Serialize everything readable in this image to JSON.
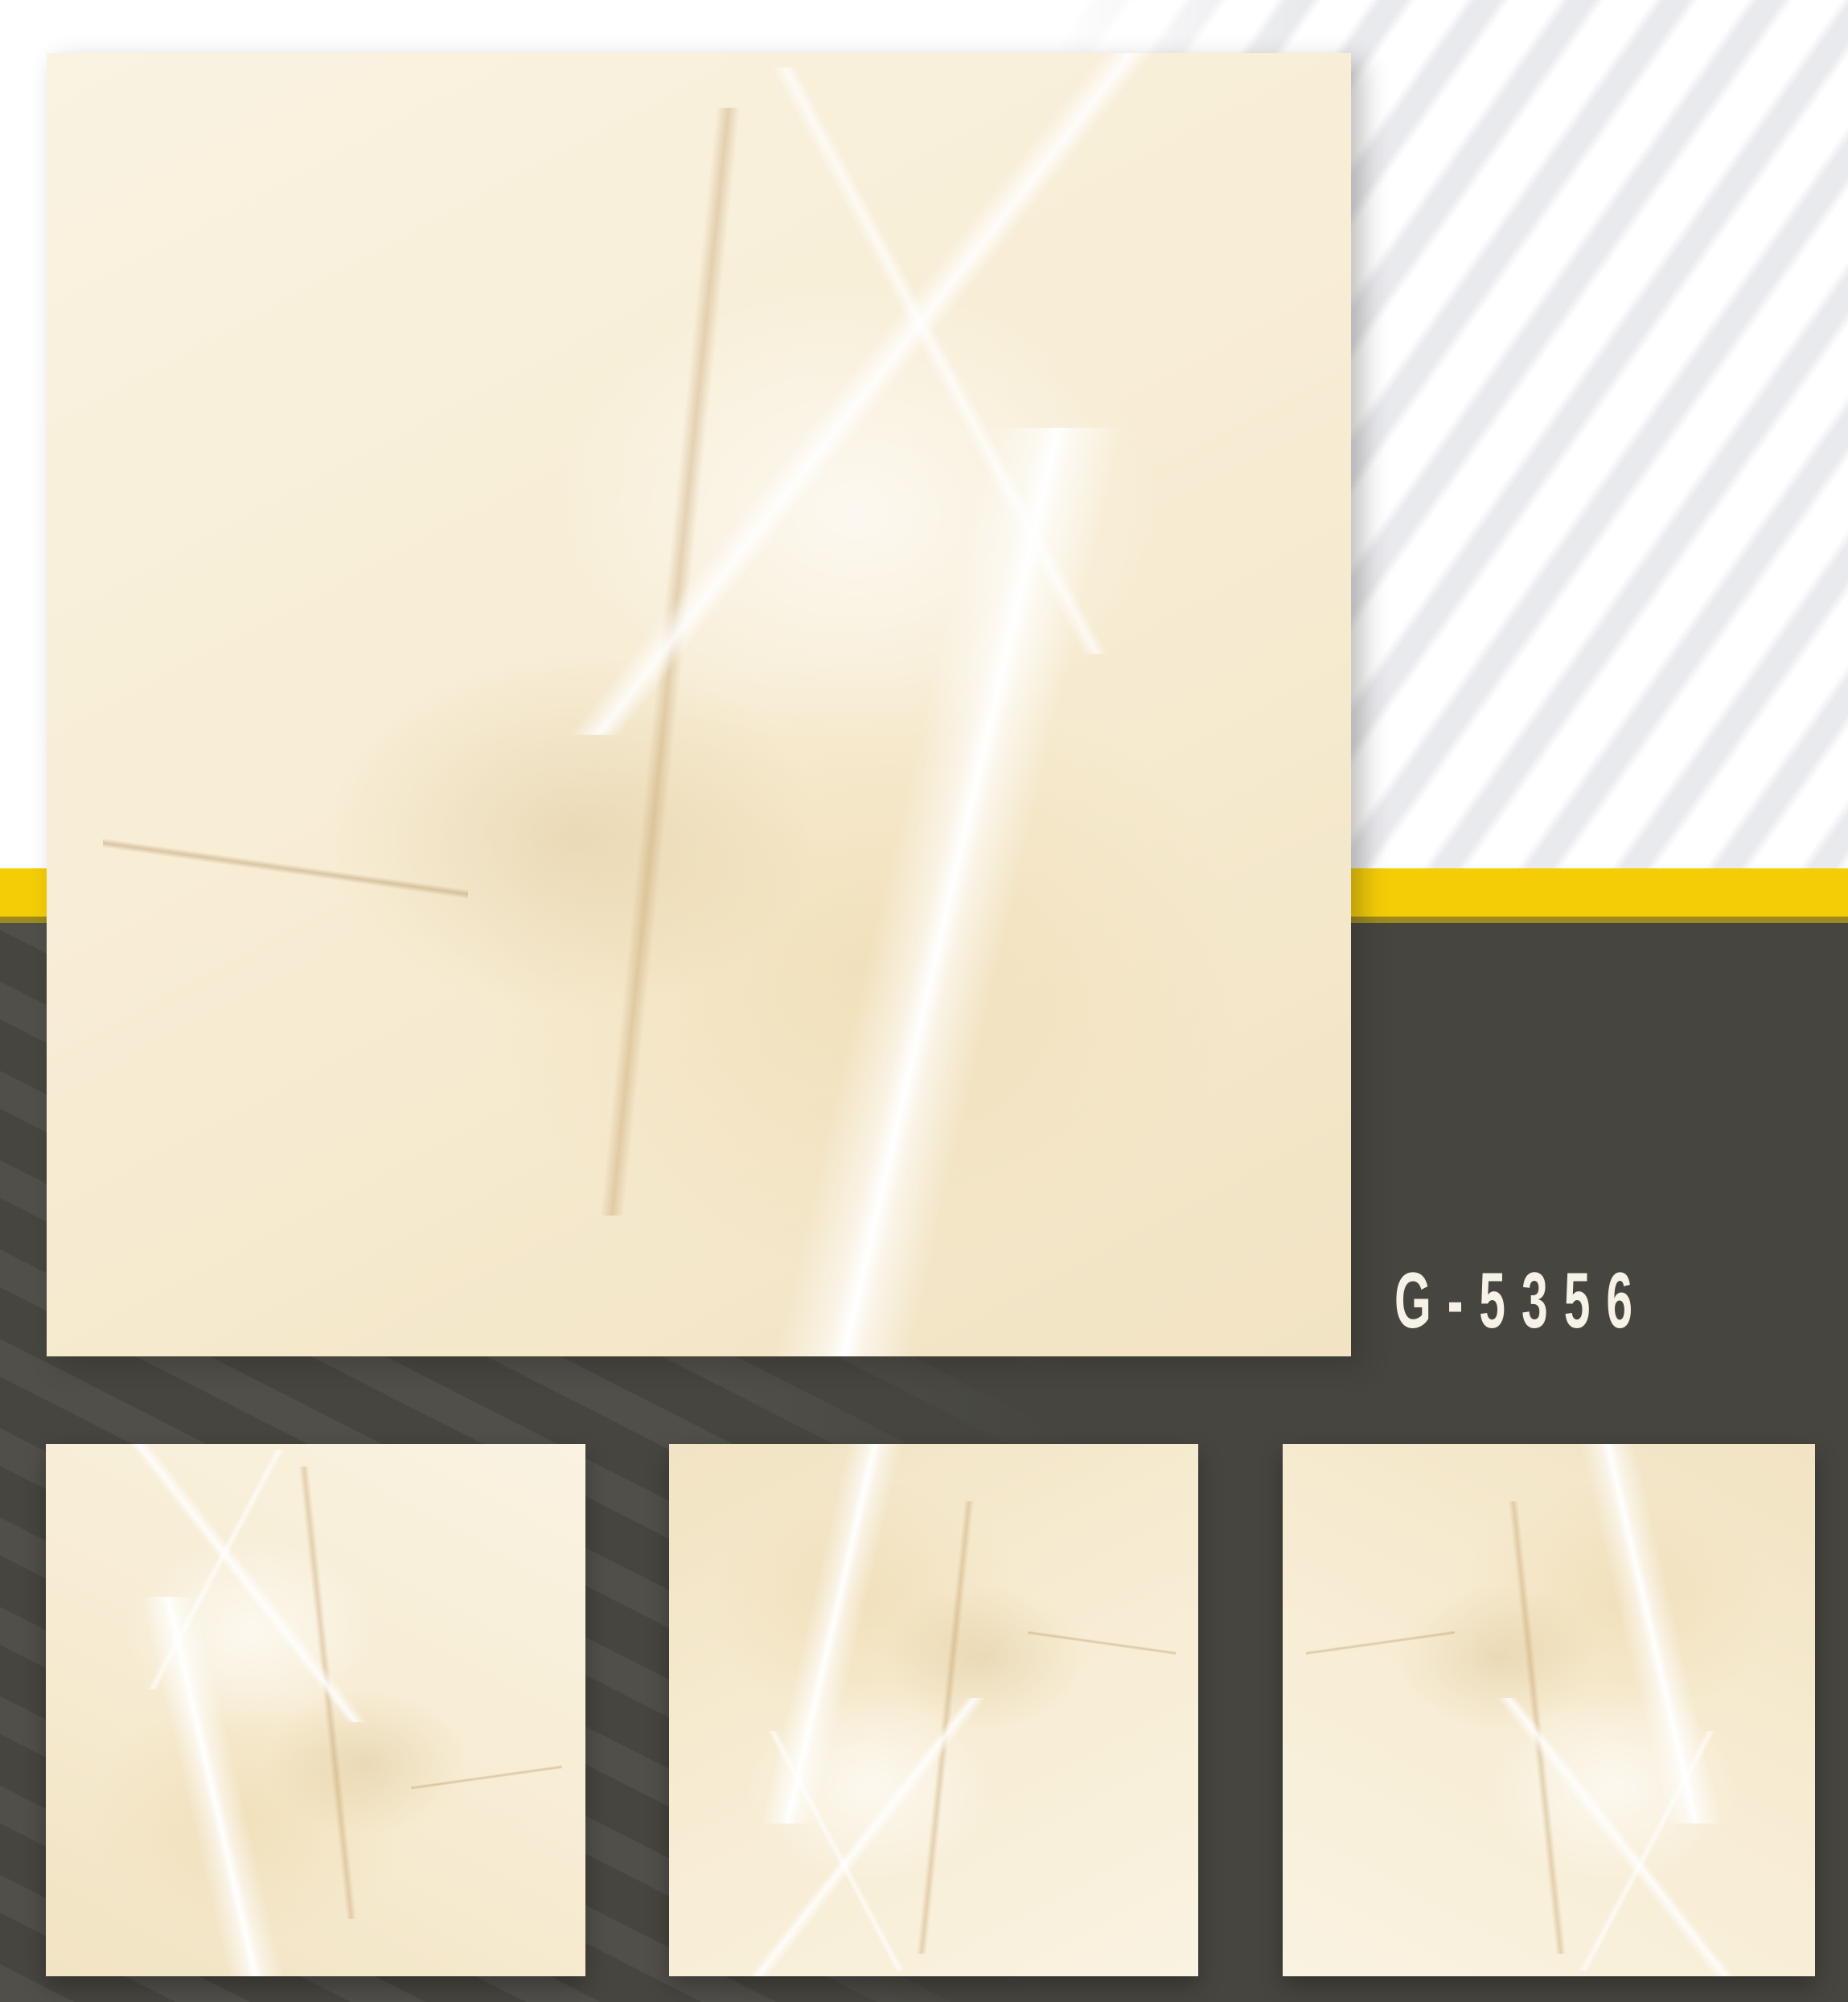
{
  "page": {
    "product_code": "G-5356",
    "colors": {
      "background_light": "#ffffff",
      "background_dark": "#46453f",
      "accent_yellow": "#f5cd07",
      "accent_yellow_edge": "#9d8a1c",
      "stripe_light_gray": "#e9e9ed",
      "stripe_dark_highlight": "#4d4c46",
      "product_code_text": "#f6f2e7",
      "marble_base": "#f7ecd3"
    },
    "hero_tile": {
      "name": "large-marble-tile-swatch"
    },
    "thumbnails": [
      {
        "name": "marble-tile-swatch-1"
      },
      {
        "name": "marble-tile-swatch-2"
      },
      {
        "name": "marble-tile-swatch-3"
      }
    ]
  }
}
